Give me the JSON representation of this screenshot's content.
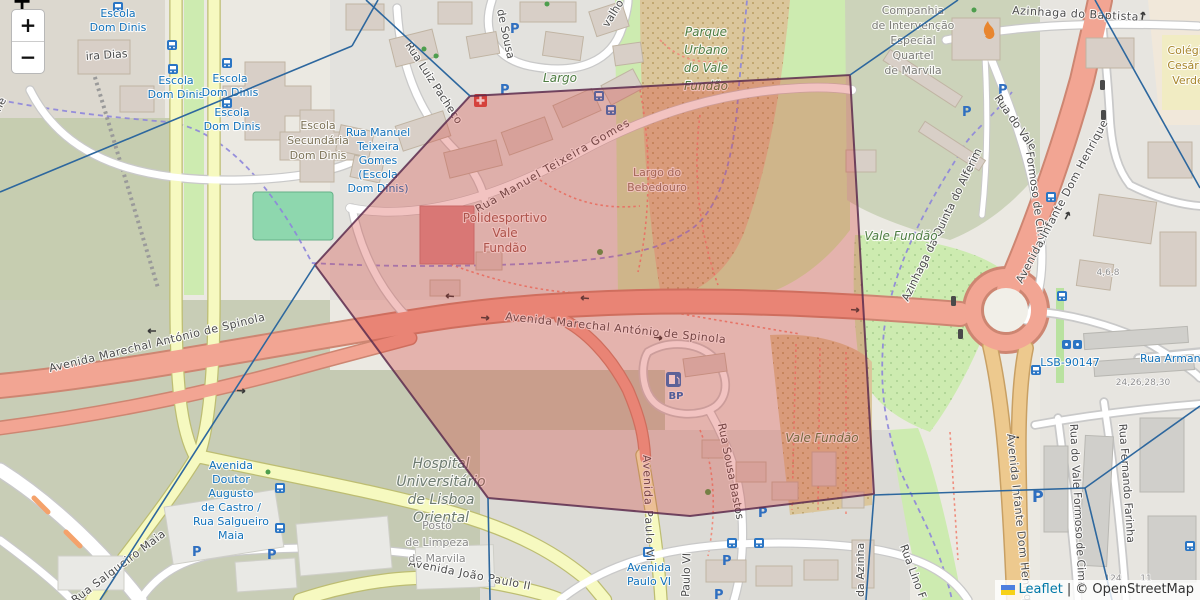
{
  "controls": {
    "zoom_in": "+",
    "zoom_out": "−",
    "clipped_plus": "+"
  },
  "attribution": {
    "leaflet": "Leaflet",
    "separator": "|",
    "osm": "© OpenStreetMap"
  },
  "labels": {
    "streets": {
      "spinola_left": "Avenida Marechal António de Spinola",
      "spinola_center": "Avenida Marechal António de Spinola",
      "teixeira_gomes": "Rua Manuel Teixeira Gomes",
      "luiz_pacheco": "Rua Luiz Pacheco",
      "de_sousa": "de Sousa",
      "carvalho_fragment": "valho",
      "ira_dias_fragment": "ira Dias",
      "he_fragment": "he",
      "baptista": "Azinhaga do Baptista",
      "vale_formoso_upper_1": "Rua do Vale",
      "vale_formoso_upper_2": "Formoso de Cima",
      "infante_ne": "Avenida Infante Dom Henrique",
      "infante_s": "Avenida Infante Dom Henrique",
      "alfenim": "Azinhaga da Quinta do Alferim",
      "sousa_bastos": "Rua Sousa Bastos",
      "paulo_vi": "Avenida Paulo VI",
      "paulo_vi_fragment": "Paulo VI",
      "azinha_fragment": "da Azinha",
      "joao_paulo": "Avenida João Paulo II",
      "salgueiro": "Rua Salgueiro Maia",
      "lino": "Rua Lino F",
      "fernando_farinha": "Rua Fernando Farinha",
      "vale_formoso_lower": "Rua do Vale Formoso de Cima"
    },
    "places": {
      "parque": [
        "Parque",
        "Urbano",
        "do Vale",
        "Fundão"
      ],
      "vale_fundao_upper": "Vale Fundão",
      "vale_fundao_lower": "Vale Fundão",
      "largo": "Largo",
      "bebedouro": [
        "Largo do",
        "Bebedouro"
      ],
      "polidesportivo": [
        "Polidesportivo",
        "Vale",
        "Fundão"
      ],
      "hospital": [
        "Hospital",
        "Universitário",
        "de Lisboa",
        "Oriental"
      ],
      "posto": [
        "Posto",
        "de Limpeza",
        "de Marvila"
      ],
      "companhia": [
        "Companhia",
        "de Intervenção",
        "Especial",
        "Quartel",
        "de Marvila"
      ],
      "colegio": [
        "Colégio",
        "Cesário",
        "Verde"
      ],
      "escola_secundaria": [
        "Escola",
        "Secundária",
        "Dom Dinis"
      ]
    },
    "transit": {
      "escola_dom_dinis": [
        "Escola",
        "Dom Dinis"
      ],
      "gomes_stop": [
        "Rua Manuel",
        "Teixeira",
        "Gomes",
        "(Escola",
        "Dom Dinis)"
      ],
      "augusto_castro": [
        "Avenida",
        "Doutor",
        "Augusto",
        "de Castro /",
        "Rua Salgueiro",
        "Maia"
      ],
      "paulo_vi_stop": [
        "Avenida",
        "Paulo VI"
      ],
      "lsb": "LSB-90147",
      "armandinho": "Rua Armandinho"
    },
    "housenumbers": {
      "h468": "4,6,8",
      "h24": "24,26,28,30",
      "h124": "124",
      "h11": "11"
    },
    "poi": {
      "bp": "BP"
    }
  },
  "colors": {
    "overlay_fill": "#d33931",
    "overlay_stroke": "#5c2c4d",
    "voronoi_line": "#2d679e",
    "admin_boundary": "#8d85dc",
    "trunk_road": "#f2a593",
    "primary_road": "#edc98e",
    "secondary_road": "#f6f9c0",
    "transit_blue": "#1272bb",
    "park_green": "#4f7d43",
    "grass": "#cdebb0"
  }
}
